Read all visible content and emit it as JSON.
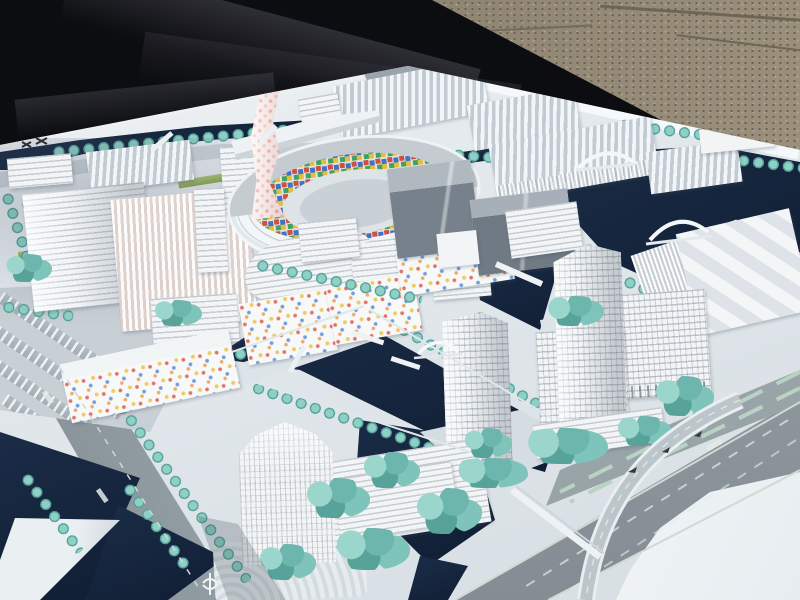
{
  "scene": {
    "description": "Outdoor photograph of a white architectural scale model of a waterfront urban district, displayed on a table with a black tarpaulin and gravel ground behind it",
    "environment": {
      "ground": "gravel",
      "cover": "black tarp"
    }
  },
  "palette": {
    "tarp_black": "#0c0d10",
    "gravel_tan": "#8a806e",
    "board_white": "#e9eef1",
    "water_navy": "#14233b",
    "road_gray": "#8d979d",
    "tree_teal": "#6fbcb2",
    "grass_green": "#a4bc6d",
    "building_white": "#f2f4f6",
    "slab_gray": "#7d8891",
    "tower_pink": "#f6e7e5",
    "mosaic_red": "#cf4f42",
    "mosaic_blue": "#3f72c8",
    "mosaic_green": "#3da364",
    "mosaic_yellow": "#e3bd3e"
  },
  "elements": {
    "tarp": "black tarpaulin covering the ground at upper left",
    "ground": "sandy gravel ground",
    "board": "white model baseboard",
    "ring": "circular courtyard building with multicolor mosaic inner facade",
    "pink_tower": "twisting tower with pink checker facade",
    "right_tower": "white high-rise tower cluster",
    "bottom_tower": "waterfront office tower with podium",
    "canal": "dark navy canal water network",
    "highway": "multi-lane highway with curved ramp",
    "bridge": "white arched model bridges",
    "trees": "teal foam model trees",
    "parking": "parking and bus bays",
    "confetti_housing": "white housing blocks with scattered colored facade dots"
  }
}
